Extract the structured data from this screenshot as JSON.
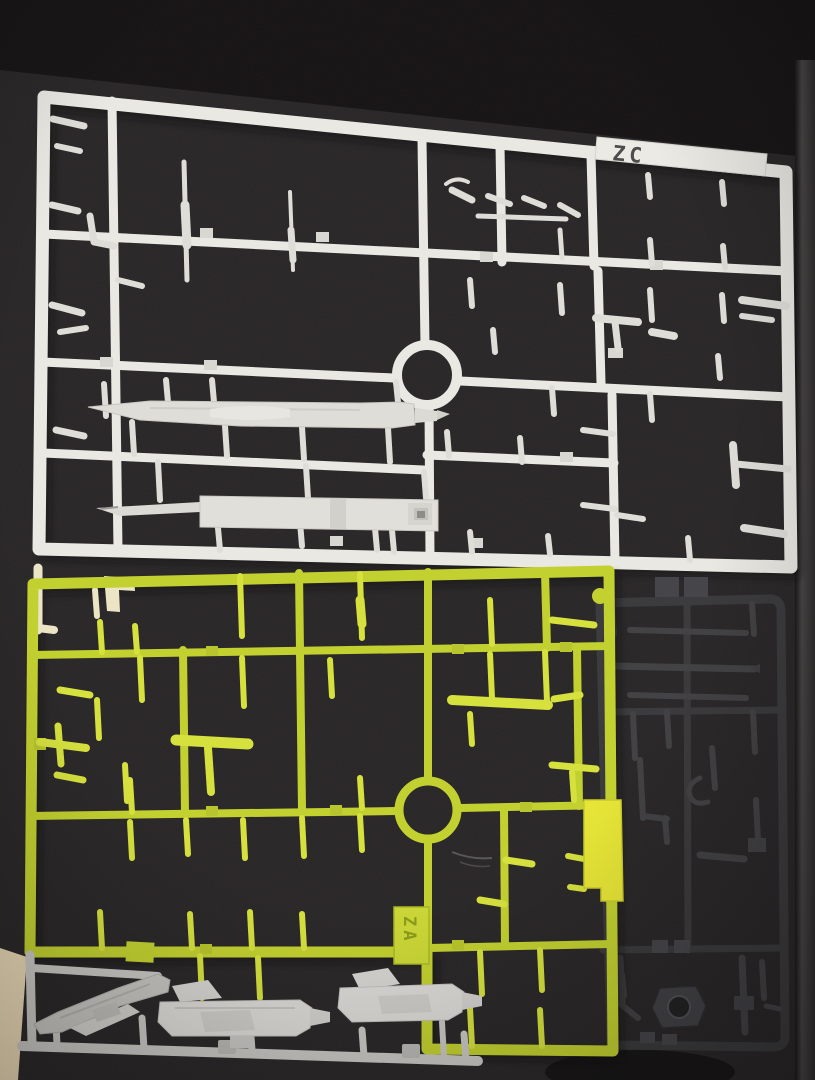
{
  "scene": {
    "type": "photograph",
    "description": "Three plastic model-kit part runners (sprues) lying on a dark textured mat: a white runner tagged ZC, a chartreuse yellow-green runner tagged ZA, and a dark grey runner; a light grey sub-runner holding two rifle parts and a curved blade sits along the bottom edge.",
    "surface": "dark cutting mat"
  },
  "labels": {
    "white_sprue_tag": "ZC",
    "yellow_sprue_tag": "ZA"
  },
  "palette": {
    "mat": "#272425",
    "table_edge": "#141112",
    "floor_corner": "#ead9b6",
    "white_sprue": "#eae8e3",
    "yellow_sprue": "#c3d130",
    "yellow_accent_part": "#e7e637",
    "pale_corner_piece": "#ece5c5",
    "dark_sprue": "#3b3b3e",
    "grey_runner": "#c9c7c3",
    "grey_weapon_parts": "#dcdad6"
  }
}
